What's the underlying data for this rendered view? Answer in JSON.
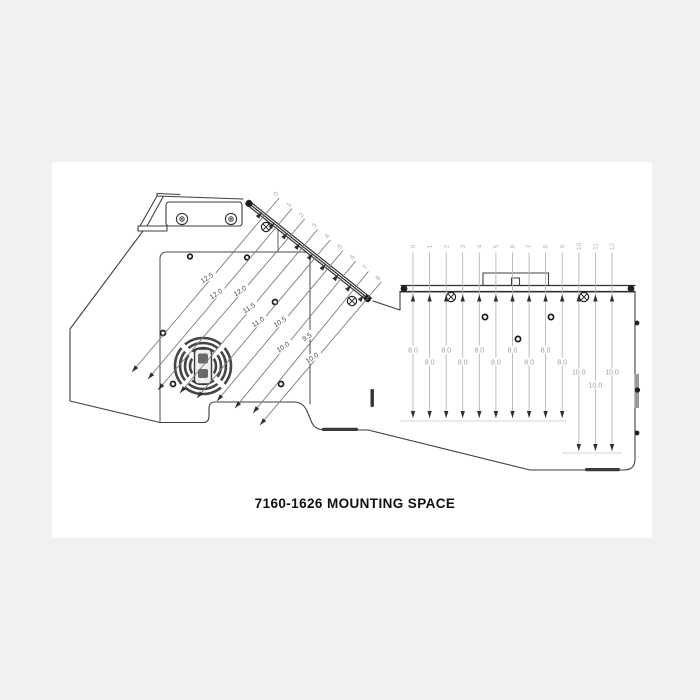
{
  "title": "7160-1626 MOUNTING SPACE",
  "left_view": {
    "station_labels": [
      "0",
      "1",
      "2",
      "3",
      "4",
      "5",
      "6",
      "7",
      "8"
    ],
    "dimensions": [
      "12.5",
      "12.0",
      "12.0",
      "11.5",
      "11.0",
      "10.5",
      "10.0",
      "9.5",
      "10.0"
    ]
  },
  "right_view": {
    "station_labels": [
      "0",
      "1",
      "2",
      "3",
      "4",
      "5",
      "6",
      "7",
      "8",
      "9",
      "10",
      "11",
      "12"
    ],
    "dimensions": [
      "8.0",
      "8.0",
      "8.0",
      "8.0",
      "8.0",
      "8.0",
      "8.0",
      "8.0",
      "8.0",
      "8.0",
      "10.0",
      "10.0",
      "10.0"
    ]
  },
  "colors": {
    "page_bg": "#f0f1f3",
    "sheet_bg": "#ffffff",
    "outline": "#3f3f3f",
    "panel": "#4a4a4a",
    "dark_fill": "#1f1f1f",
    "left_dim_line": "#7a7a7a",
    "left_dim_text": "#4f4f4f",
    "left_station_text": "#a6a6a6",
    "right_dim_line": "#b5b5b5",
    "right_dim_text": "#9e9e9e",
    "right_station_text": "#b5b5b5",
    "arrow": "#2f2f2f",
    "baseline": "#c4c4c4",
    "title_text": "#101010"
  }
}
